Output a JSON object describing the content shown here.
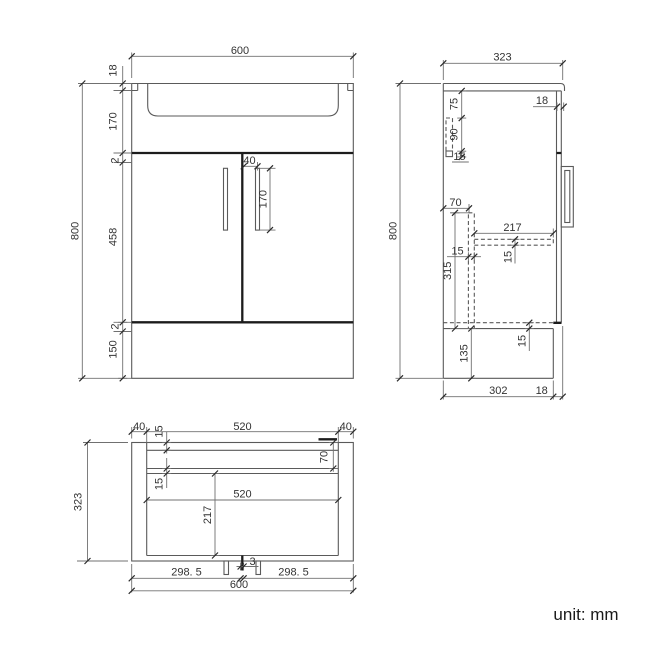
{
  "drawing": {
    "type": "technical-orthographic-drawing",
    "subject": "vanity-unit-with-basin",
    "unit_note": "unit: mm",
    "views": {
      "front_view": {
        "overall_width": "600",
        "overall_height": "800",
        "visible_dims": [
          "600",
          "18",
          "170",
          "2",
          "458",
          "2",
          "150",
          "800",
          "40",
          "170"
        ]
      },
      "side_view": {
        "overall_depth": "323",
        "overall_height": "800",
        "visible_dims": [
          "323",
          "18",
          "75",
          "90",
          "15",
          "70",
          "217",
          "15",
          "315",
          "15",
          "15",
          "135",
          "800",
          "302",
          "18"
        ]
      },
      "plan_view": {
        "overall_width": "600",
        "overall_depth": "323",
        "visible_dims": [
          "40",
          "15",
          "520",
          "40",
          "70",
          "15",
          "520",
          "217",
          "323",
          "298. 5",
          "3",
          "298. 5",
          "600"
        ]
      }
    },
    "style_colors": {
      "background": "#ffffff",
      "outline": "#5a5a5a",
      "seam": "#1c1c1c",
      "dimension": "#707070",
      "text": "#333333"
    }
  },
  "labels": [
    {
      "id": "front-width",
      "text": "600"
    },
    {
      "id": "front-top-thickness",
      "text": "18"
    },
    {
      "id": "front-basin-depth",
      "text": "170"
    },
    {
      "id": "front-gap-top",
      "text": "2"
    },
    {
      "id": "front-door-height",
      "text": "458"
    },
    {
      "id": "front-gap-bottom",
      "text": "2"
    },
    {
      "id": "front-plinth-height",
      "text": "150"
    },
    {
      "id": "front-height",
      "text": "800"
    },
    {
      "id": "front-handle-offset",
      "text": "40"
    },
    {
      "id": "front-handle-length",
      "text": "170"
    },
    {
      "id": "side-depth",
      "text": "323"
    },
    {
      "id": "side-counter-overhang",
      "text": "18"
    },
    {
      "id": "side-rail-offset",
      "text": "75"
    },
    {
      "id": "side-rail-height",
      "text": "90"
    },
    {
      "id": "side-rail-strip",
      "text": "15"
    },
    {
      "id": "side-divider-offset",
      "text": "70"
    },
    {
      "id": "side-shelf-depth",
      "text": "217"
    },
    {
      "id": "side-divider-thickness",
      "text": "15"
    },
    {
      "id": "side-divider-height",
      "text": "315"
    },
    {
      "id": "side-shelf-thickness",
      "text": "15"
    },
    {
      "id": "side-bottom-thickness",
      "text": "15"
    },
    {
      "id": "side-plinth-height",
      "text": "135"
    },
    {
      "id": "side-height",
      "text": "800"
    },
    {
      "id": "side-bottom-depth",
      "text": "302"
    },
    {
      "id": "side-bottom-overhang",
      "text": "18"
    },
    {
      "id": "plan-side-left",
      "text": "40"
    },
    {
      "id": "plan-back-thickness",
      "text": "15"
    },
    {
      "id": "plan-inner-width-top",
      "text": "520"
    },
    {
      "id": "plan-side-right",
      "text": "40"
    },
    {
      "id": "plan-divider-offset",
      "text": "70"
    },
    {
      "id": "plan-divider-thickness",
      "text": "15"
    },
    {
      "id": "plan-inner-width",
      "text": "520"
    },
    {
      "id": "plan-shelf-depth",
      "text": "217"
    },
    {
      "id": "plan-depth",
      "text": "323"
    },
    {
      "id": "plan-door-left",
      "text": "298. 5"
    },
    {
      "id": "plan-door-gap",
      "text": "3"
    },
    {
      "id": "plan-door-right",
      "text": "298. 5"
    },
    {
      "id": "plan-width",
      "text": "600"
    }
  ],
  "note": {
    "text": "unit: mm"
  }
}
